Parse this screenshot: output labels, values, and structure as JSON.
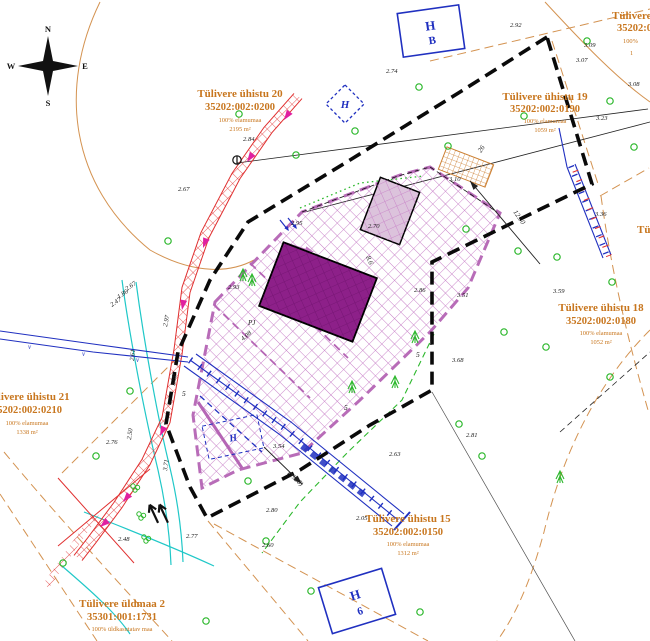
{
  "map": {
    "compass": {
      "n": "N",
      "e": "E",
      "s": "S",
      "w": "W"
    },
    "parcels": [
      {
        "name": "Tülivere ühistu 20",
        "code": "35202:002:0200",
        "usage": "100% elamumaa",
        "area": "2195 m²"
      },
      {
        "name": "Tülivere ühistu 19",
        "code": "35202:002:0190",
        "usage": "100% elamumaa",
        "area": "1059 m²"
      },
      {
        "name": "Tülivere ühistu 18",
        "code": "35202:002:0180",
        "usage": "100% elamumaa",
        "area": "1052 m²"
      },
      {
        "name": "Tülivere ühistu 15",
        "code": "35202:002:0150",
        "usage": "100% elamumaa",
        "area": "1312 m²"
      },
      {
        "name": "Tülivere ühistu 21",
        "code": "35202:002:0210",
        "usage": "100% elamumaa",
        "area": "1338 m²"
      },
      {
        "name": "Tülivere üldmaa 2",
        "code": "35301:001:1731",
        "usage": "100% üldkasutatav maa",
        "area": ""
      },
      {
        "name": "Tülivere",
        "code": "35202:0",
        "usage": "100%",
        "area": "1"
      },
      {
        "name": "Tü",
        "code": "",
        "usage": "",
        "area": ""
      }
    ],
    "markers": {
      "box_top": {
        "line1": "H",
        "line2": "B"
      },
      "box_bottom": {
        "line1": "H",
        "line2": "6"
      },
      "diamond": "H",
      "dashed_box": "H",
      "pump_label": "PJ",
      "v_label": "v",
      "lot_numbers": [
        "5",
        "1",
        "5",
        "5"
      ]
    },
    "measurements": {
      "d1": "12.50",
      "d2": "26",
      "d3": "8.6",
      "note": "(1990)"
    },
    "elevations": [
      "2.92",
      "2.74",
      "3.09",
      "3.07",
      "3.23",
      "2.84",
      "2.67",
      "2.95",
      "2.70",
      "2.86",
      "3.51",
      "3.59",
      "3.36",
      "3.68",
      "2.81",
      "2.63",
      "2.80",
      "2.60",
      "2.05",
      "2.76",
      "2.67",
      "1.86",
      "2.47",
      "2.61",
      "2.97",
      "3.09",
      "2.50",
      "3.71",
      "2.77",
      "2.48",
      "2.93",
      "4.08",
      "3.54",
      "3.10",
      "3.08"
    ],
    "colors": {
      "label_orange": "#c8761e",
      "boundary_black": "#0a0a0a",
      "plan_purple": "#b565b5",
      "building_fill": "#8d2089",
      "outbuilding_fill": "#dcc3dc",
      "utility_blue": "#2030c0",
      "ditch_red": "#e03030",
      "drain_cyan": "#20c8c8",
      "veg_green": "#2db82d",
      "contour_orange": "#cc8033",
      "arrow_magenta": "#e020a0"
    }
  }
}
